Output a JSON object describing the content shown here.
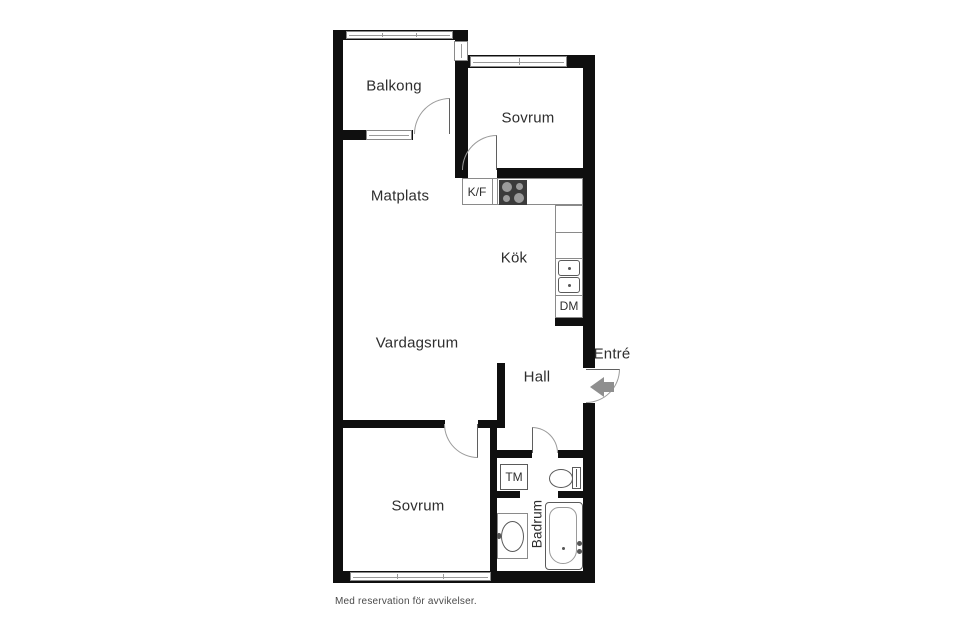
{
  "labels": {
    "balkong": "Balkong",
    "sovrum_top": "Sovrum",
    "matplats": "Matplats",
    "kf": "K/F",
    "kok": "Kök",
    "dm": "DM",
    "vardagsrum": "Vardagsrum",
    "hall": "Hall",
    "entre": "Entré",
    "sovrum_bottom": "Sovrum",
    "tm": "TM",
    "badrum": "Badrum"
  },
  "footer": {
    "disclaimer": "Med reservation för avvikelser."
  },
  "colors": {
    "wall": "#0f0f0f",
    "fixture_outline": "#5a5a5a",
    "window_outline": "#8a8a8a",
    "stove": "#3b3b3b",
    "entry_arrow": "#8f8f8f",
    "label_text": "#2e2e2e",
    "footer_text": "#4a4a4a"
  }
}
